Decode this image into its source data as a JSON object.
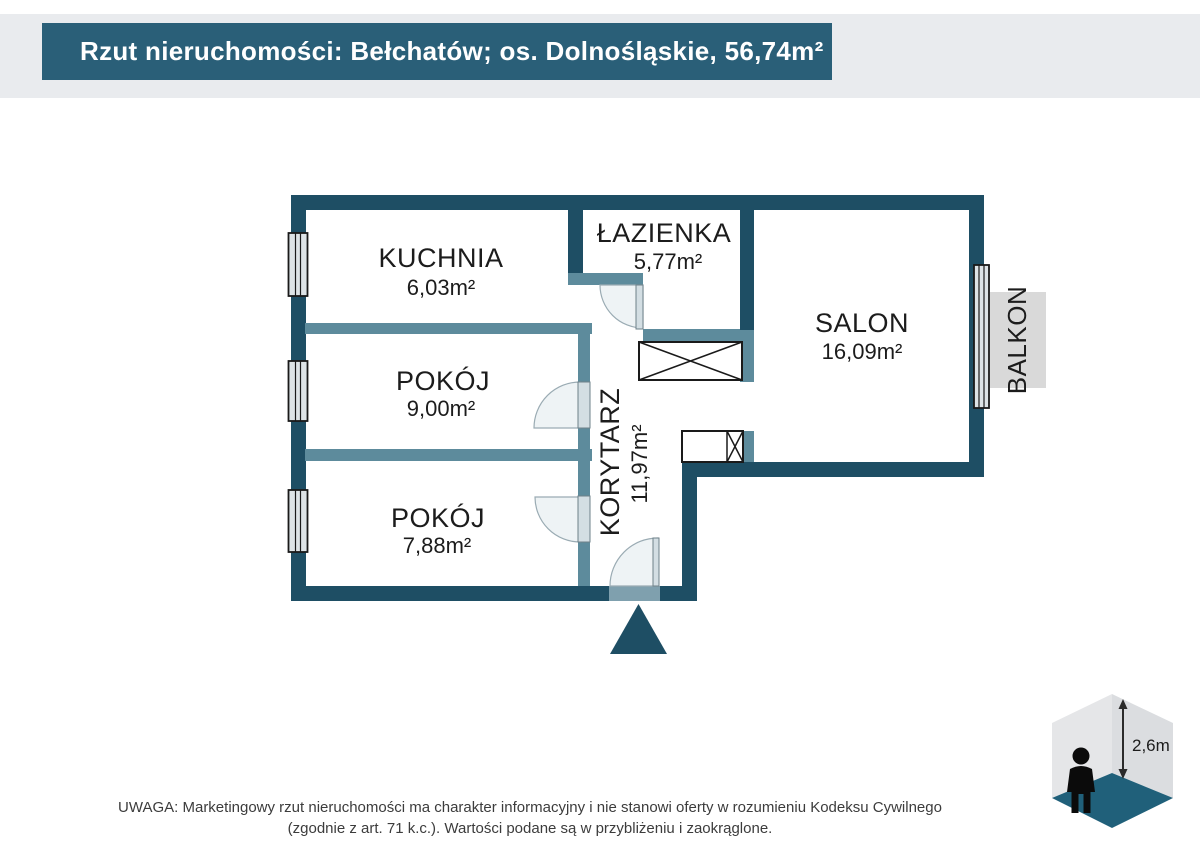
{
  "header": {
    "title": "Rzut nieruchomości: Bełchatów; os. Dolnośląskie, 56,74m²"
  },
  "plan": {
    "rooms": [
      {
        "name": "KUCHNIA",
        "area": "6,03m²"
      },
      {
        "name": "ŁAZIENKA",
        "area": "5,77m²"
      },
      {
        "name": "SALON",
        "area": "16,09m²"
      },
      {
        "name": "POKÓJ",
        "area": "9,00m²"
      },
      {
        "name": "POKÓJ",
        "area": "7,88m²"
      },
      {
        "name": "KORYTARZ",
        "area": "11,97m²"
      }
    ],
    "balcony_label": "BALKON"
  },
  "height_indicator": {
    "label": "2,6m"
  },
  "disclaimer": {
    "line1": "UWAGA: Marketingowy rzut nieruchomości ma charakter informacyjny i nie stanowi oferty w rozumieniu Kodeksu Cywilnego",
    "line2": "(zgodnie z art. 71 k.c.). Wartości podane są w przybliżeniu i zaokrąglone."
  },
  "colors": {
    "wall_dark": "#1e4e64",
    "wall_light": "#5d8b9c",
    "header_bg": "#2a5f78",
    "strip_bg": "#e9ebee",
    "balcony_gray": "#d9d9d9",
    "threshold": "#7fa0ae",
    "cube_wall_left": "#e5e6e8",
    "cube_wall_right": "#dbdde0",
    "cube_floor": "#20607a"
  }
}
